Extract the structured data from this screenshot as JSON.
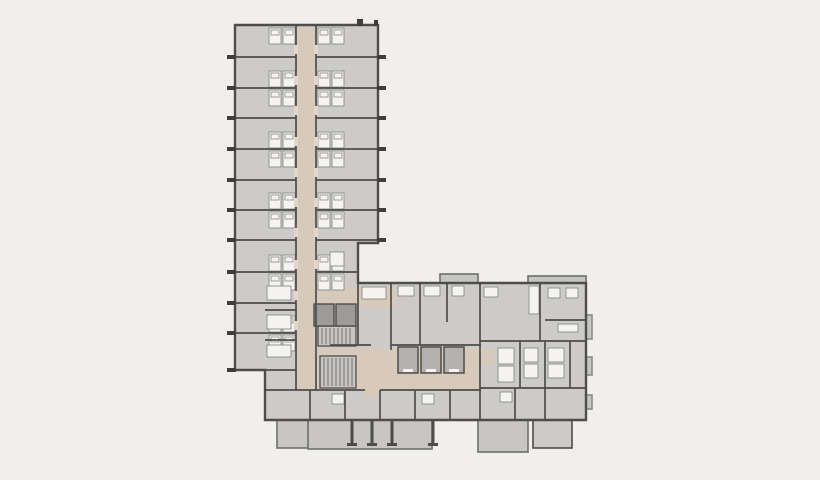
{
  "canvas": {
    "width": 820,
    "height": 480
  },
  "palette": {
    "background": "#f0efee",
    "floor": "#cccbc9",
    "corridor": "#d8cabb",
    "corridor_light": "#e2d7ca",
    "wall": "#4e4d4b",
    "wall_light": "#8b8a88",
    "fixture_white": "#f4f3f1",
    "shaft_gray": "#9c9b99",
    "elevator_gray": "#b4b2b0",
    "stair_gray": "#c6c5c3",
    "balcony_gray": "#c7c6c4",
    "balcony_stroke": "#6f6e6c",
    "tick_dark": "#3f3e3d"
  },
  "floor_plan": {
    "type": "architectural-floor-plan",
    "outline_path": "M 235,25 L 378,25 L 378,243 L 358,243 L 358,283 L 586,283 L 586,420 L 265,420 L 265,370 L 235,370 Z",
    "underlays": [
      {
        "x": 277,
        "y": 403,
        "w": 32,
        "h": 45,
        "fill": "balcony_gray",
        "stroke": "balcony_stroke"
      },
      {
        "x": 308,
        "y": 416,
        "w": 124,
        "h": 33,
        "fill": "balcony_gray",
        "stroke": "balcony_stroke"
      },
      {
        "x": 478,
        "y": 412,
        "w": 50,
        "h": 40,
        "fill": "balcony_gray",
        "stroke": "balcony_stroke"
      },
      {
        "x": 533,
        "y": 396,
        "w": 39,
        "h": 52,
        "fill": "floor",
        "stroke": "wall"
      },
      {
        "x": 440,
        "y": 274,
        "w": 38,
        "h": 12,
        "fill": "balcony_gray",
        "stroke": "balcony_stroke"
      },
      {
        "x": 528,
        "y": 276,
        "w": 58,
        "h": 9,
        "fill": "balcony_gray",
        "stroke": "balcony_stroke"
      },
      {
        "x": 586,
        "y": 315,
        "w": 6,
        "h": 24,
        "fill": "balcony_gray",
        "stroke": "wall_light"
      },
      {
        "x": 586,
        "y": 357,
        "w": 6,
        "h": 18,
        "fill": "balcony_gray",
        "stroke": "wall_light"
      },
      {
        "x": 586,
        "y": 395,
        "w": 6,
        "h": 14,
        "fill": "balcony_gray",
        "stroke": "wall_light"
      }
    ],
    "corridors": [
      {
        "x": 296,
        "y": 28,
        "w": 20,
        "h": 362
      },
      {
        "x": 316,
        "y": 288,
        "w": 80,
        "h": 20
      },
      {
        "x": 316,
        "y": 348,
        "w": 165,
        "h": 42
      },
      {
        "x": 365,
        "y": 390,
        "w": 15,
        "h": 8
      },
      {
        "x": 481,
        "y": 349,
        "w": 14,
        "h": 16
      }
    ],
    "stairs": [
      {
        "x": 318,
        "y": 326,
        "w": 38,
        "h": 20
      },
      {
        "x": 320,
        "y": 356,
        "w": 36,
        "h": 32
      }
    ],
    "shafts": [
      {
        "x": 314,
        "y": 304,
        "w": 20,
        "h": 22
      },
      {
        "x": 336,
        "y": 304,
        "w": 20,
        "h": 22
      }
    ],
    "elevators": [
      {
        "x": 398,
        "y": 347,
        "w": 20,
        "h": 26
      },
      {
        "x": 421,
        "y": 347,
        "w": 20,
        "h": 26
      },
      {
        "x": 444,
        "y": 347,
        "w": 20,
        "h": 26
      }
    ],
    "walls": [
      [
        296,
        25,
        296,
        390
      ],
      [
        316,
        25,
        316,
        390
      ],
      [
        235,
        57,
        296,
        57
      ],
      [
        235,
        88,
        296,
        88
      ],
      [
        235,
        118,
        296,
        118
      ],
      [
        235,
        149,
        296,
        149
      ],
      [
        235,
        180,
        296,
        180
      ],
      [
        235,
        210,
        296,
        210
      ],
      [
        235,
        240,
        296,
        240
      ],
      [
        235,
        272,
        296,
        272
      ],
      [
        235,
        303,
        296,
        303
      ],
      [
        235,
        333,
        296,
        333
      ],
      [
        316,
        57,
        378,
        57
      ],
      [
        316,
        88,
        378,
        88
      ],
      [
        316,
        118,
        378,
        118
      ],
      [
        316,
        149,
        378,
        149
      ],
      [
        316,
        180,
        378,
        180
      ],
      [
        316,
        210,
        378,
        210
      ],
      [
        316,
        240,
        378,
        240
      ],
      [
        316,
        272,
        358,
        272
      ],
      [
        235,
        370,
        296,
        370
      ],
      [
        265,
        310,
        296,
        310
      ],
      [
        265,
        340,
        296,
        340
      ],
      [
        358,
        283,
        358,
        345
      ],
      [
        391,
        283,
        391,
        350
      ],
      [
        330,
        345,
        371,
        345
      ],
      [
        391,
        345,
        481,
        345
      ],
      [
        265,
        390,
        365,
        390
      ],
      [
        380,
        390,
        481,
        390
      ],
      [
        420,
        283,
        420,
        345
      ],
      [
        447,
        283,
        447,
        322
      ],
      [
        480,
        283,
        480,
        420
      ],
      [
        540,
        283,
        540,
        341
      ],
      [
        545,
        320,
        586,
        320
      ],
      [
        480,
        341,
        586,
        341
      ],
      [
        480,
        388,
        586,
        388
      ],
      [
        520,
        341,
        520,
        388
      ],
      [
        545,
        341,
        545,
        388
      ],
      [
        570,
        341,
        570,
        388
      ],
      [
        310,
        390,
        310,
        420
      ],
      [
        345,
        390,
        345,
        420
      ],
      [
        380,
        390,
        380,
        420
      ],
      [
        415,
        390,
        415,
        420
      ],
      [
        450,
        390,
        450,
        420
      ],
      [
        515,
        388,
        515,
        420
      ],
      [
        545,
        388,
        545,
        420
      ]
    ],
    "door_gaps": [
      {
        "x": 294,
        "y": 45
      },
      {
        "x": 294,
        "y": 76
      },
      {
        "x": 294,
        "y": 106
      },
      {
        "x": 294,
        "y": 137
      },
      {
        "x": 294,
        "y": 168
      },
      {
        "x": 294,
        "y": 198
      },
      {
        "x": 294,
        "y": 228
      },
      {
        "x": 294,
        "y": 260
      },
      {
        "x": 294,
        "y": 291
      },
      {
        "x": 294,
        "y": 321
      },
      {
        "x": 314,
        "y": 45
      },
      {
        "x": 314,
        "y": 76
      },
      {
        "x": 314,
        "y": 106
      },
      {
        "x": 314,
        "y": 137
      },
      {
        "x": 314,
        "y": 168
      },
      {
        "x": 314,
        "y": 198
      },
      {
        "x": 314,
        "y": 228
      },
      {
        "x": 314,
        "y": 260
      }
    ],
    "bed_clusters": [
      {
        "x": 269,
        "y": 28
      },
      {
        "x": 318,
        "y": 28
      },
      {
        "x": 269,
        "y": 71
      },
      {
        "x": 318,
        "y": 71
      },
      {
        "x": 269,
        "y": 90
      },
      {
        "x": 318,
        "y": 90
      },
      {
        "x": 269,
        "y": 132
      },
      {
        "x": 318,
        "y": 132
      },
      {
        "x": 269,
        "y": 151
      },
      {
        "x": 318,
        "y": 151
      },
      {
        "x": 269,
        "y": 193
      },
      {
        "x": 318,
        "y": 193
      },
      {
        "x": 269,
        "y": 212
      },
      {
        "x": 318,
        "y": 212
      },
      {
        "x": 269,
        "y": 255
      },
      {
        "x": 318,
        "y": 255
      },
      {
        "x": 269,
        "y": 274
      },
      {
        "x": 318,
        "y": 274
      },
      {
        "x": 269,
        "y": 316
      },
      {
        "x": 269,
        "y": 335
      }
    ],
    "fixtures": [
      {
        "x": 267,
        "y": 286,
        "w": 24,
        "h": 14
      },
      {
        "x": 267,
        "y": 315,
        "w": 24,
        "h": 14
      },
      {
        "x": 267,
        "y": 345,
        "w": 24,
        "h": 12
      },
      {
        "x": 362,
        "y": 287,
        "w": 24,
        "h": 12
      },
      {
        "x": 398,
        "y": 286,
        "w": 16,
        "h": 10
      },
      {
        "x": 424,
        "y": 286,
        "w": 16,
        "h": 10
      },
      {
        "x": 452,
        "y": 286,
        "w": 12,
        "h": 10
      },
      {
        "x": 484,
        "y": 287,
        "w": 14,
        "h": 10
      },
      {
        "x": 529,
        "y": 286,
        "w": 10,
        "h": 28
      },
      {
        "x": 548,
        "y": 288,
        "w": 12,
        "h": 10
      },
      {
        "x": 566,
        "y": 288,
        "w": 12,
        "h": 10
      },
      {
        "x": 558,
        "y": 324,
        "w": 20,
        "h": 8
      },
      {
        "x": 498,
        "y": 348,
        "w": 16,
        "h": 16
      },
      {
        "x": 498,
        "y": 366,
        "w": 16,
        "h": 16
      },
      {
        "x": 524,
        "y": 348,
        "w": 14,
        "h": 14
      },
      {
        "x": 524,
        "y": 364,
        "w": 14,
        "h": 14
      },
      {
        "x": 548,
        "y": 348,
        "w": 16,
        "h": 14
      },
      {
        "x": 548,
        "y": 364,
        "w": 16,
        "h": 14
      },
      {
        "x": 500,
        "y": 392,
        "w": 12,
        "h": 10
      },
      {
        "x": 332,
        "y": 394,
        "w": 12,
        "h": 10
      },
      {
        "x": 422,
        "y": 394,
        "w": 12,
        "h": 10
      },
      {
        "x": 330,
        "y": 252,
        "w": 14,
        "h": 14
      }
    ],
    "balcony_posts": [
      {
        "x": 352
      },
      {
        "x": 372
      },
      {
        "x": 392
      },
      {
        "x": 433
      }
    ],
    "ticks": [
      {
        "x": 227,
        "y": 55,
        "w": 9,
        "h": 4
      },
      {
        "x": 227,
        "y": 86,
        "w": 9,
        "h": 4
      },
      {
        "x": 227,
        "y": 116,
        "w": 9,
        "h": 4
      },
      {
        "x": 227,
        "y": 147,
        "w": 9,
        "h": 4
      },
      {
        "x": 227,
        "y": 178,
        "w": 9,
        "h": 4
      },
      {
        "x": 227,
        "y": 208,
        "w": 9,
        "h": 4
      },
      {
        "x": 227,
        "y": 238,
        "w": 9,
        "h": 4
      },
      {
        "x": 227,
        "y": 270,
        "w": 9,
        "h": 4
      },
      {
        "x": 227,
        "y": 301,
        "w": 9,
        "h": 4
      },
      {
        "x": 227,
        "y": 331,
        "w": 9,
        "h": 4
      },
      {
        "x": 227,
        "y": 368,
        "w": 9,
        "h": 4
      },
      {
        "x": 377,
        "y": 55,
        "w": 9,
        "h": 4
      },
      {
        "x": 377,
        "y": 86,
        "w": 9,
        "h": 4
      },
      {
        "x": 377,
        "y": 116,
        "w": 9,
        "h": 4
      },
      {
        "x": 377,
        "y": 147,
        "w": 9,
        "h": 4
      },
      {
        "x": 377,
        "y": 178,
        "w": 9,
        "h": 4
      },
      {
        "x": 377,
        "y": 208,
        "w": 9,
        "h": 4
      },
      {
        "x": 377,
        "y": 238,
        "w": 9,
        "h": 4
      },
      {
        "x": 357,
        "y": 19,
        "w": 6,
        "h": 7
      },
      {
        "x": 374,
        "y": 20,
        "w": 4,
        "h": 6
      }
    ]
  }
}
